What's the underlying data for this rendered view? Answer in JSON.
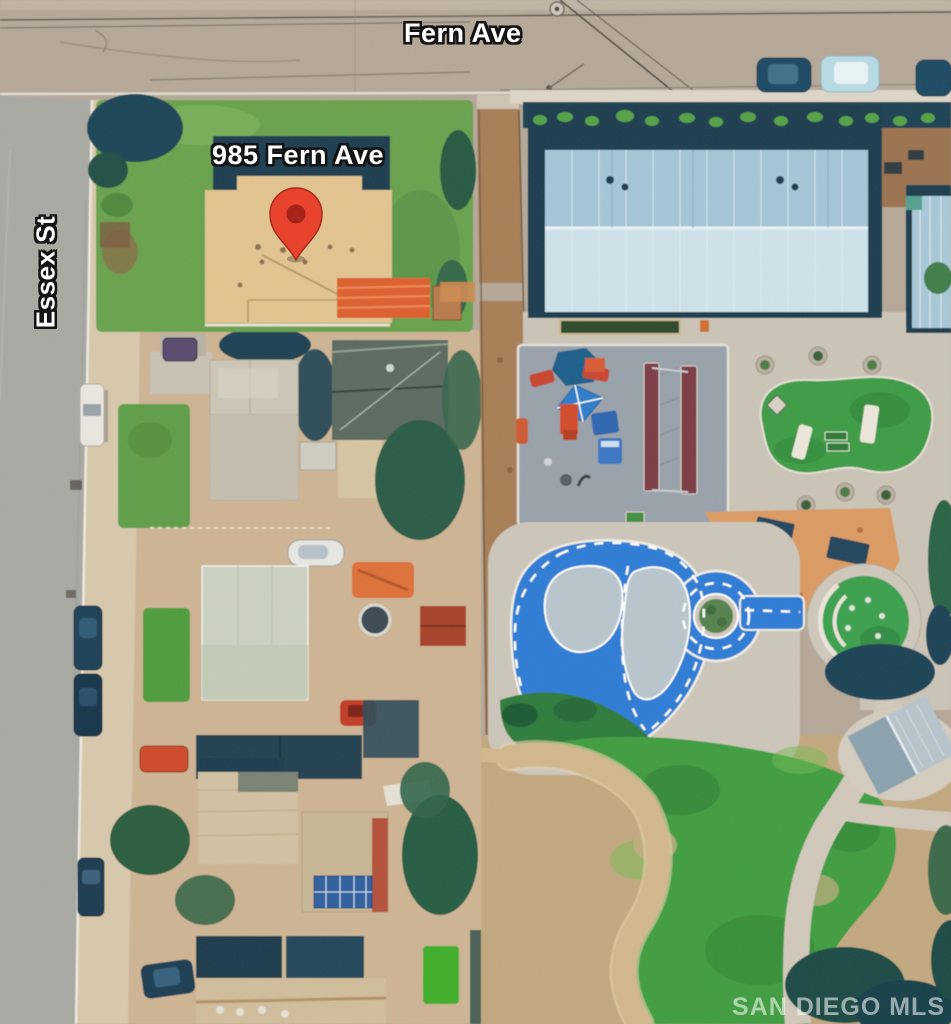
{
  "map": {
    "view": "aerial-satellite-photo",
    "address_label": "985 Fern Ave",
    "streets": {
      "horizontal": "Fern Ave",
      "vertical": "Essex St"
    },
    "watermark": "SAN DIEGO MLS",
    "pin": {
      "label": "subject-property-location",
      "color": "#e8432d",
      "inner_color": "#a6241a"
    },
    "features": [
      "subject-property-tan-roof",
      "orange-tile-roof-wing",
      "gym-building-blue-roof",
      "playground",
      "swing-bays",
      "trike-track-blue-loop",
      "roundabout-tree-island",
      "picnic-area",
      "grass-mound-with-benches",
      "amphitheater-circle",
      "restroom-building",
      "park-lawn",
      "dirt-alley",
      "residential-houses",
      "parked-cars"
    ],
    "colors": {
      "road_fern": "#b5a898",
      "road_essex": "#a9a9a3",
      "sidewalk": "#d8c9ac",
      "subject_lawn": "#69a24e",
      "subject_roof": "#e2c48f",
      "orange_roof": "#dd5f2d",
      "gym_roof_upper": "#a6c6d6",
      "gym_roof_lower": "#cfe2e9",
      "tree_shadow_teal": "#1c4152",
      "playground_surface": "#99a1aa",
      "swing_bay_maroon": "#7c3b44",
      "trike_track_blue": "#2e7cd6",
      "track_island_gray": "#b9c5cc",
      "park_grass": "#3f9d3f",
      "dirt_path": "#a87e54",
      "plaza_concrete": "#cbc4b7",
      "picnic_sand": "#dc9a62"
    }
  }
}
